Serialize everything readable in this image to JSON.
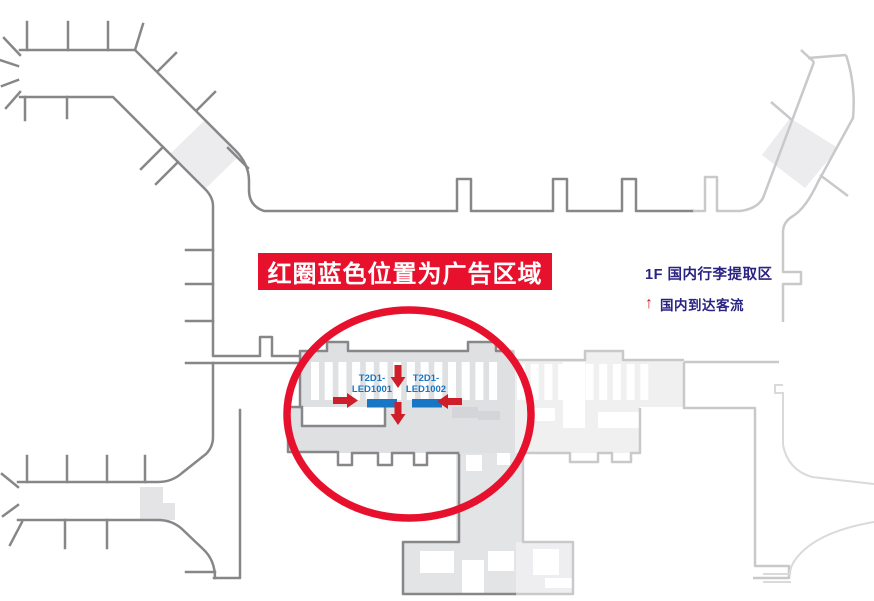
{
  "banner": {
    "text": "红圈蓝色位置为广告区域"
  },
  "legend": {
    "title": "1F 国内行李提取区",
    "flow_arrow": "↑",
    "flow_label": "国内到达客流"
  },
  "ad_spots": [
    {
      "id": "T2D1-LED1001",
      "line1": "T2D1-",
      "line2": "LED1001"
    },
    {
      "id": "T2D1-LED1002",
      "line1": "T2D1-",
      "line2": "LED1002"
    }
  ],
  "colors": {
    "highlight_circle": "#e8112d",
    "banner_bg": "#e8112d",
    "banner_text": "#ffffff",
    "ad_marker": "#1777c5",
    "ad_label": "#1777c5",
    "flow_arrow": "#cf1e2a",
    "legend_text": "#2b2383",
    "wall_dark": "#87878a",
    "wall_light": "#c9c9cb",
    "wall_faint": "#dadadc",
    "hall_fill": "#dfe0e2"
  }
}
